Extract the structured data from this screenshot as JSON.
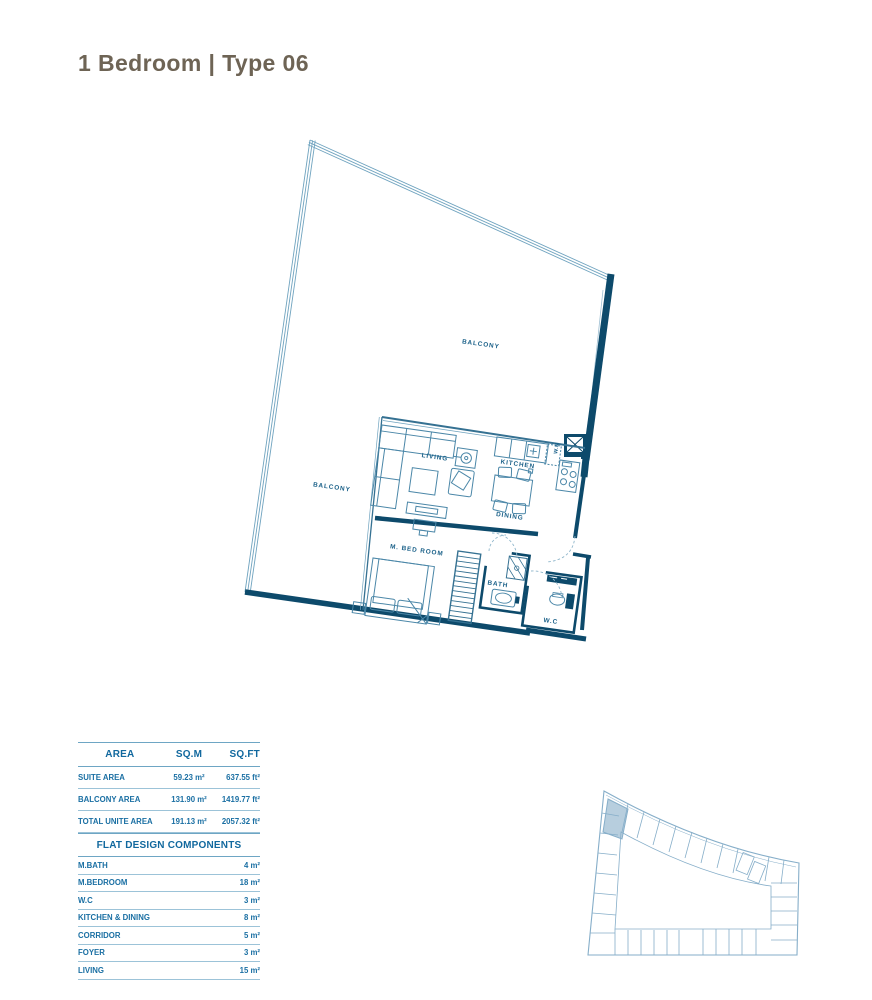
{
  "title": "1 Bedroom | Type 06",
  "colors": {
    "wall": "#0d4a6b",
    "thin_line": "#4b87a8",
    "glass_line": "#6fa3bf",
    "label_text": "#1b6189",
    "table_text": "#1a6fa3",
    "table_header_text": "#11689e",
    "table_line": "#9cc3d8",
    "title_text": "#6e6455",
    "minimap_line": "#86aec9",
    "minimap_highlight": "#b7cede"
  },
  "plan": {
    "labels": {
      "balcony_top": "BALCONY",
      "balcony_left": "BALCONY",
      "living": "LIVING",
      "kitchen": "KITCHEN",
      "dining": "DINING",
      "washing_machine": "W.M",
      "bedroom": "M. BED ROOM",
      "bath": "BATH",
      "wc": "W.C"
    }
  },
  "area_table": {
    "headers": [
      "AREA",
      "SQ.M",
      "SQ.FT"
    ],
    "rows": [
      {
        "label": "SUITE AREA",
        "sqm": "59.23 m²",
        "sqft": "637.55 ft²"
      },
      {
        "label": "BALCONY AREA",
        "sqm": "131.90 m²",
        "sqft": "1419.77 ft²"
      },
      {
        "label": "TOTAL UNITE AREA",
        "sqm": "191.13 m²",
        "sqft": "2057.32 ft²"
      }
    ]
  },
  "components_table": {
    "title": "FLAT DESIGN COMPONENTS",
    "rows": [
      {
        "label": "M.BATH",
        "value": "4 m²"
      },
      {
        "label": "M.BEDROOM",
        "value": "18 m²"
      },
      {
        "label": "W.C",
        "value": "3 m²"
      },
      {
        "label": "KITCHEN & DINING",
        "value": "8 m²"
      },
      {
        "label": "CORRIDOR",
        "value": "5 m²"
      },
      {
        "label": "FOYER",
        "value": "3 m²"
      },
      {
        "label": "LIVING",
        "value": "15 m²"
      }
    ]
  }
}
